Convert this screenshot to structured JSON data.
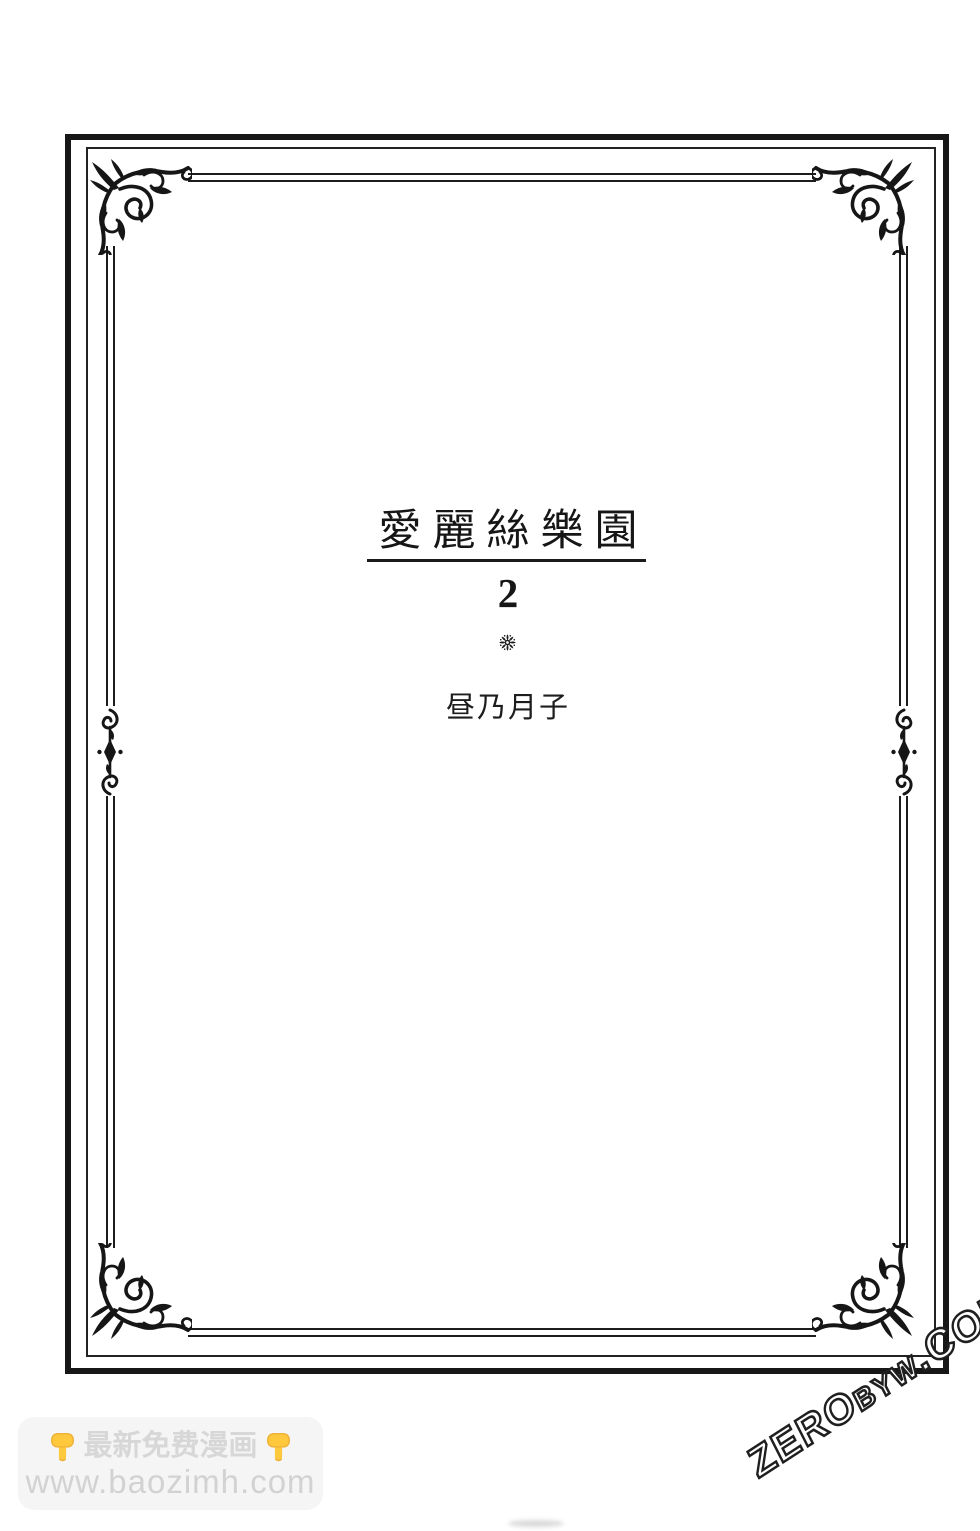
{
  "page": {
    "background_color": "#ffffff",
    "frame_color": "#171717",
    "title": "愛麗絲樂園",
    "volume": "2",
    "divider_symbol": "❋",
    "author": "昼乃月子"
  },
  "watermarks": {
    "baozimh": {
      "hand_icon": "👇",
      "line1": "最新免费漫画",
      "line2": "www.baozimh.com",
      "badge_color": "#f5f5f5",
      "text_color": "#d7d7d7",
      "hand_color": "#FFC83D"
    },
    "zerobyw": {
      "part1": "ZERO",
      "part2": "BYW",
      "part3": ".COM",
      "style": "outlined-diagonal"
    }
  }
}
